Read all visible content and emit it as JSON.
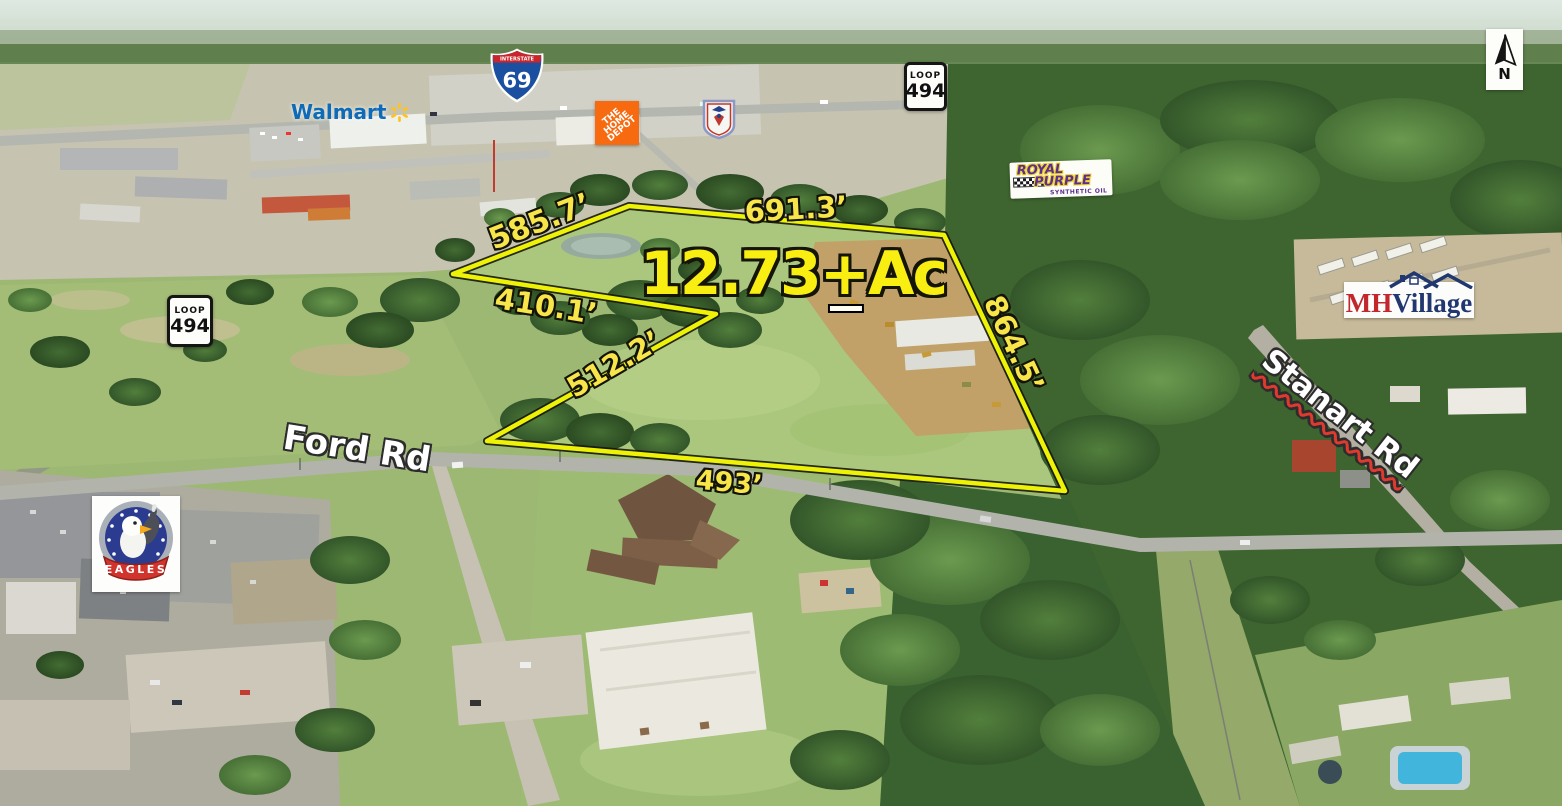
{
  "overlay": {
    "acreage": {
      "number": "12.73",
      "plus": "+",
      "suffix": "Ac"
    },
    "measurements": {
      "nw": "585.7’",
      "north": "691.3’",
      "notch_upper": "410.1’",
      "notch_lower": "512.2’",
      "east": "864.5’",
      "south": "493’"
    },
    "roads": {
      "ford": "Ford Rd",
      "stanart": "Stanart Rd"
    }
  },
  "signs": {
    "interstate69": {
      "header": "INTERSTATE",
      "number": "69"
    },
    "loop494_top": {
      "header": "LOOP",
      "number": "494"
    },
    "loop494_left": {
      "header": "LOOP",
      "number": "494"
    },
    "north_arrow": {
      "letter": "N"
    }
  },
  "logos": {
    "walmart": {
      "wordmark": "Walmart"
    },
    "home_depot": {
      "line1": "THE",
      "line2": "HOME",
      "line3": "DEPOT"
    },
    "royal_purple": {
      "word1": "ROYAL",
      "word2": "PURPLE",
      "tagline": "SYNTHETIC OIL"
    },
    "mhvillage": {
      "mh": "MH",
      "village": "Village"
    },
    "eagles": {
      "banner": "EAGLES"
    }
  },
  "colors": {
    "boundary": "#edf207",
    "measurement_text": "#f8e54a",
    "acreage_text": "#f9ee12",
    "road_label_text": "#ffffff"
  }
}
